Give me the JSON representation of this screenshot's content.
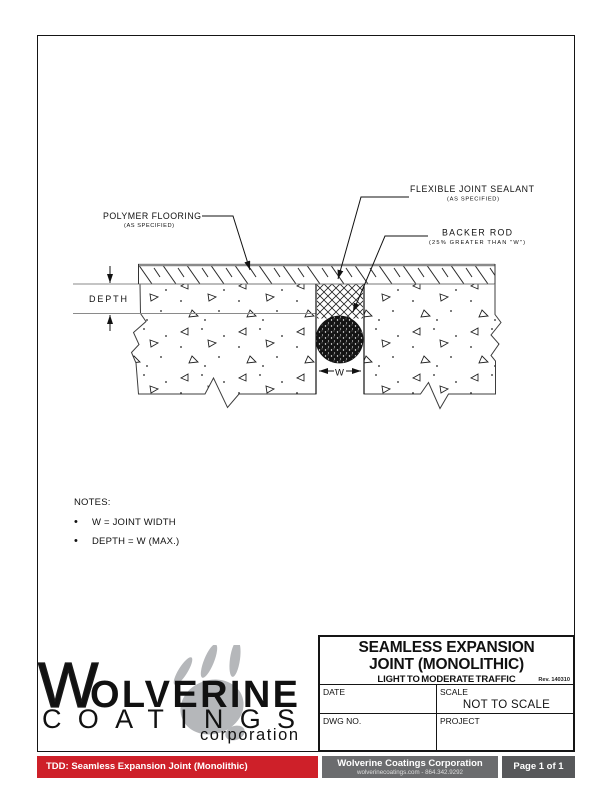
{
  "drawing": {
    "labels": {
      "polymer_flooring": "POLYMER FLOORING",
      "polymer_flooring_sub": "(AS SPECIFIED)",
      "joint_sealant": "FLEXIBLE JOINT SEALANT",
      "joint_sealant_sub": "(AS SPECIFIED)",
      "backer_rod": "BACKER ROD",
      "backer_rod_sub": "(25% GREATER THAN \"W\")",
      "depth_dim": "DEPTH",
      "width_dim": "W"
    }
  },
  "notes": {
    "heading": "NOTES:",
    "items": [
      "W = JOINT WIDTH",
      "DEPTH = W (MAX.)"
    ]
  },
  "logo": {
    "initial": "W",
    "name_rest": "OLVERINE",
    "line2": "COATINGS",
    "line3": "corporation"
  },
  "title_block": {
    "title_line1": "SEAMLESS EXPANSION",
    "title_line2": "JOINT (MONOLITHIC)",
    "subtitle": "LIGHT TO MODERATE TRAFFIC",
    "revision": "Rev. 140310",
    "date_label": "DATE",
    "scale_label": "SCALE",
    "scale_value": "NOT TO SCALE",
    "dwg_label": "DWG NO.",
    "project_label": "PROJECT"
  },
  "footer": {
    "doc_title": "TDD: Seamless Expansion Joint (Monolithic)",
    "company": "Wolverine Coatings Corporation",
    "contact": "wolverinecoatings.com - 864.342.9292",
    "page_indicator": "Page 1 of 1"
  },
  "colors": {
    "accent_red": "#ce2029",
    "bar_gray": "#6b6c6e",
    "bar_dark": "#57585a",
    "logo_red": "#c2202e",
    "logo_blue": "#3b74b5",
    "paw_gray": "#b5b7ba"
  }
}
